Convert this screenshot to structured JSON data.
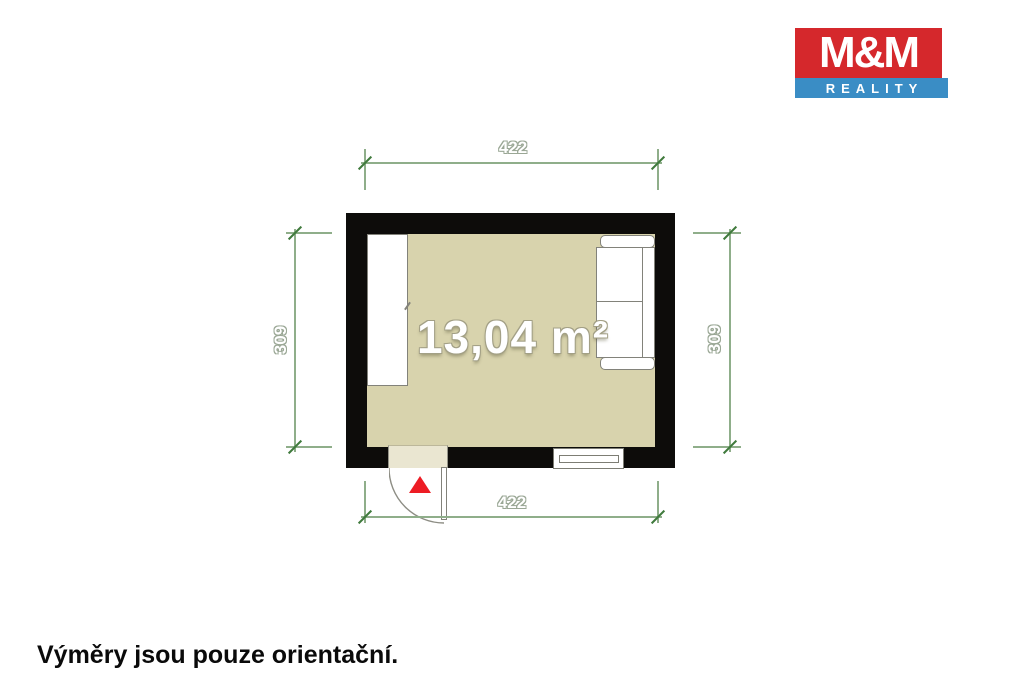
{
  "branding": {
    "logo_top": "M&M",
    "logo_banner": "REALITY"
  },
  "floorplan": {
    "area_label": "13,04 m²",
    "dim_top": "422",
    "dim_bottom": "422",
    "dim_left": "309",
    "dim_right": "309"
  },
  "footer": {
    "disclaimer": "Výměry jsou pouze orientační."
  },
  "colors": {
    "wall": "#0d0c0a",
    "floor": "#d8d3ad",
    "door-floor": "#eae6d1",
    "dim-line": "#8fae8a",
    "dim-tick": "#3f7a3c",
    "dim-text-outline": "#9aa795",
    "outline-gray": "#82827a",
    "logo-red": "#d5282c",
    "logo-blue": "#3a8dc5",
    "arrow-red": "#ed1c24"
  }
}
